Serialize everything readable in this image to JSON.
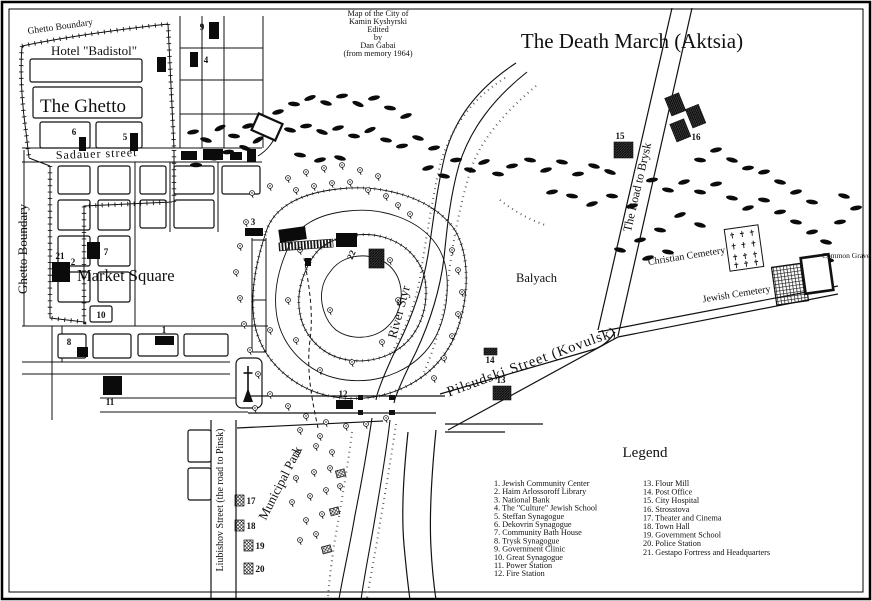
{
  "attribution": {
    "line1": "Map of the City of",
    "line2": "Kamin Kyshyrski",
    "line3": "Edited",
    "line4": "by",
    "line5": "Dan Gabai",
    "line6": "(from memory 1964)"
  },
  "title": "The Death March (Aktsia)",
  "labels": {
    "ghetto_boundary_top": "Ghetto Boundary",
    "ghetto_boundary_left": "Ghetto Boundary",
    "hotel": "Hotel \"Badistol\"",
    "the_ghetto": "The Ghetto",
    "sadauer_street": "Sadauer street",
    "market_square": "Market Square",
    "balyach": "Balyach",
    "river_styr": "River Styr",
    "road_to_brysk": "The Road to Brysk",
    "pilsudski": "Pilsudski Street (Kovulsk)",
    "christian_cemetery": "Christian Cemetery",
    "jewish_cemetery": "Jewish Cemetery",
    "common_grave": "Common Grave",
    "municipal_park": "Municipal Park",
    "liubishov": "Liubishov Street (the road to Pinsk)"
  },
  "markers": {
    "m1": "1",
    "m2": "2",
    "m3": "3",
    "m4": "4",
    "m5": "5",
    "m6": "6",
    "m7": "7",
    "m8": "8",
    "m9": "9",
    "m10": "10",
    "m11": "11",
    "m12": "12",
    "m13": "13",
    "m14": "14",
    "m15": "15",
    "m16": "16",
    "m17": "17",
    "m18": "18",
    "m19": "19",
    "m20": "20",
    "m21": "21",
    "m22": "22"
  },
  "legend": {
    "title": "Legend",
    "col1": [
      "1.  Jewish Community Center",
      "2.  Haim Arlossoroff Library",
      "3.  National Bank",
      "4.  The \"Culture\" Jewish School",
      "5.  Steffan Synagogue",
      "6.  Dekovrin Synagogue",
      "7.  Community Bath House",
      "8.  Trysk Synagogue",
      "9.  Government Clinic",
      "10. Great Synagogue",
      "11. Power Station",
      "12. Fire Station"
    ],
    "col2": [
      "13. Flour Mill",
      "14. Post Office",
      "15. City Hospital",
      "16. Strosstova",
      "17. Theater and Cinema",
      "18. Town Hall",
      "19. Government School",
      "20. Police Station",
      "21. Gestapo Fortress and Headquarters"
    ]
  }
}
